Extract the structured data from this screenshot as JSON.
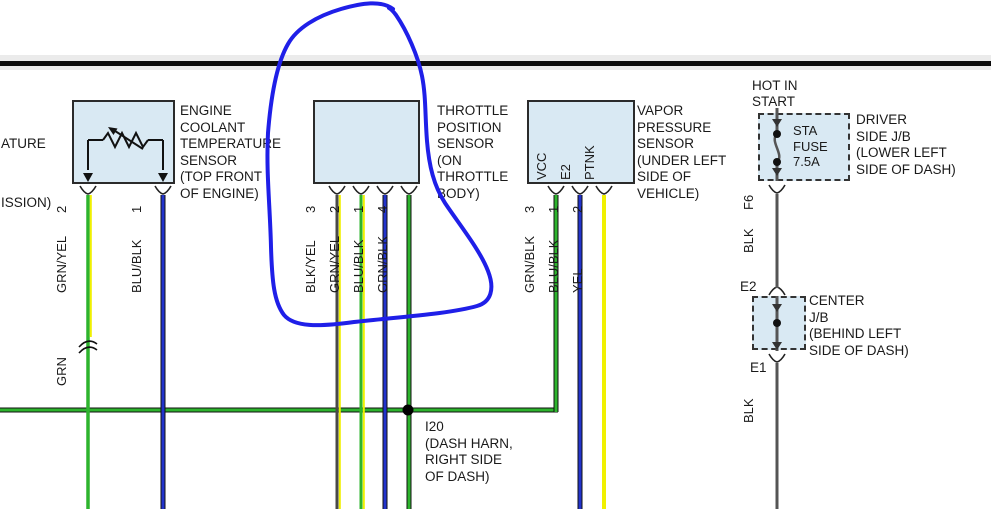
{
  "colors": {
    "wire_green": "#2db42d",
    "wire_yellow": "#f0f000",
    "wire_blue": "#2233cc",
    "wire_black_gray": "#4d4d4d",
    "component_fill": "#d9e9f3",
    "annotation_blue": "#1f1fe8",
    "text": "#1a1a1a"
  },
  "clipped_left": {
    "line1": "ATURE",
    "line2": "ISSION)"
  },
  "ect": {
    "label": "ENGINE\nCOOLANT\nTEMPERATURE\nSENSOR\n(TOP FRONT\nOF ENGINE)",
    "pins": [
      {
        "num": "2",
        "wire": "GRN/YEL"
      },
      {
        "num": "1",
        "wire": "BLU/BLK"
      }
    ],
    "splice_wire": "GRN"
  },
  "tps": {
    "label": "THROTTLE\nPOSITION\nSENSOR\n(ON\nTHROTTLE\nBODY)",
    "pins": [
      {
        "num": "3",
        "wire": "BLK/YEL"
      },
      {
        "num": "2",
        "wire": "GRN/YEL"
      },
      {
        "num": "1",
        "wire": "BLU/BLK"
      },
      {
        "num": "4",
        "wire": "GRN/BLK"
      }
    ]
  },
  "vapor": {
    "label": "VAPOR\nPRESSURE\nSENSOR\n(UNDER LEFT\nSIDE OF\nVEHICLE)",
    "terminals": [
      "VCC",
      "E2",
      "PTNK"
    ],
    "pins": [
      {
        "num": "3",
        "wire": "GRN/BLK"
      },
      {
        "num": "1",
        "wire": "BLU/BLK"
      },
      {
        "num": "2",
        "wire": "YEL"
      }
    ]
  },
  "driver_jb": {
    "power_label": "HOT IN\nSTART",
    "fuse_label": "STA\nFUSE\n7.5A",
    "label": "DRIVER\nSIDE J/B\n(LOWER LEFT\nSIDE OF DASH)",
    "pin_out": "F6",
    "wire_out": "BLK"
  },
  "center_jb": {
    "label": "CENTER\nJ/B\n(BEHIND LEFT\nSIDE OF DASH)",
    "pin_in": "E2",
    "pin_out": "E1",
    "wire_out": "BLK"
  },
  "junction_i20": {
    "label": "I20\n(DASH HARN,\nRIGHT SIDE\nOF DASH)"
  }
}
